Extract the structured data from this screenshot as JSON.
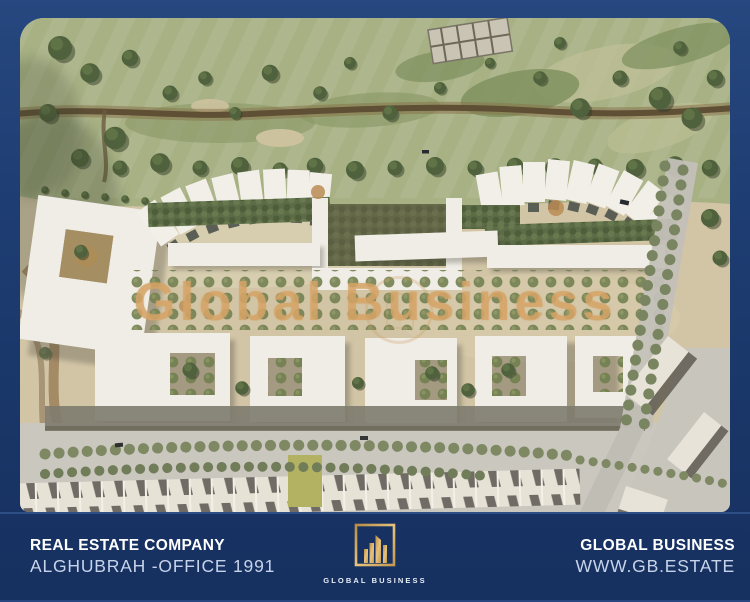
{
  "watermark": {
    "text": "Global Business"
  },
  "footer": {
    "company": {
      "line1": "REAL ESTATE COMPANY",
      "line2": "ALGHUBRAH -OFFICE 1991"
    },
    "brand": {
      "line1": "GLOBAL BUSINESS",
      "line2": "WWW.GB.ESTATE"
    },
    "logo": {
      "caption": "GLOBAL BUSINESS"
    }
  },
  "colors": {
    "frame_navy": "#1e3d72",
    "footer_dark": "#071a47",
    "footer_light": "#2a5cb0",
    "logo_gold": "#d4aa5e",
    "watermark_tan": "#d5a467",
    "sand": "#d5c7a5",
    "grass": "#a8b381",
    "building_white": "#f3f0e7"
  }
}
